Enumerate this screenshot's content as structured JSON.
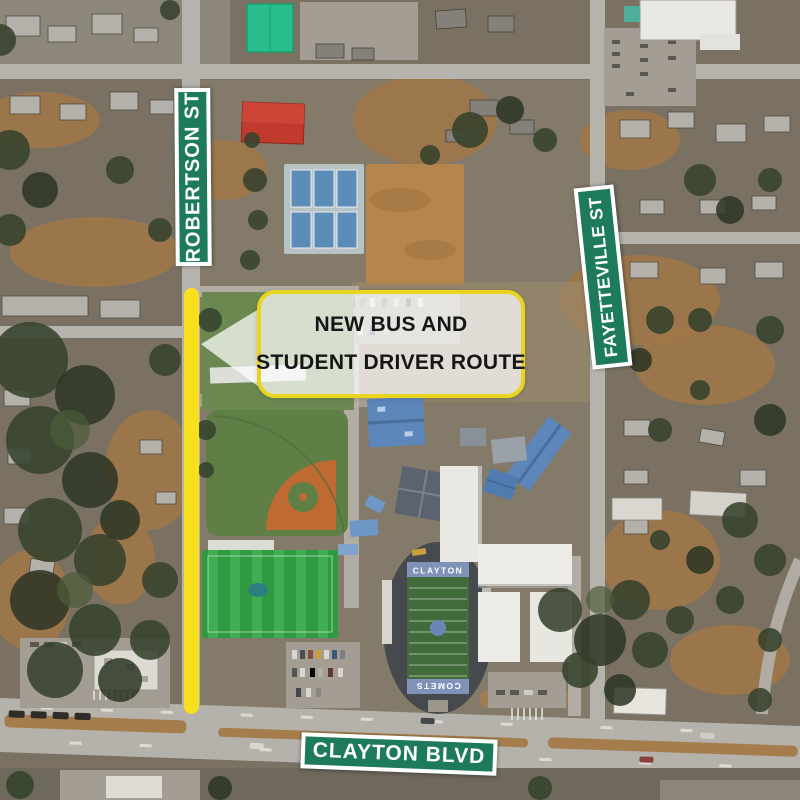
{
  "map": {
    "description": "Aerial photo of Clayton High School campus and surrounding streets",
    "football_field": {
      "top_endzone": "CLAYTON",
      "bottom_endzone": "COMETS"
    }
  },
  "street_signs": {
    "robertson": {
      "label": "ROBERTSON ST"
    },
    "fayetteville": {
      "label": "FAYETTEVILLE ST"
    },
    "clayton_blvd": {
      "label": "CLAYTON BLVD"
    }
  },
  "callout": {
    "line1": "NEW BUS AND",
    "line2": "STUDENT DRIVER ROUTE"
  },
  "colors": {
    "sign_green": "#1d7b5c",
    "route_yellow": "#f8e01f",
    "callout_border": "#e9d41f",
    "callout_text": "#161616"
  }
}
